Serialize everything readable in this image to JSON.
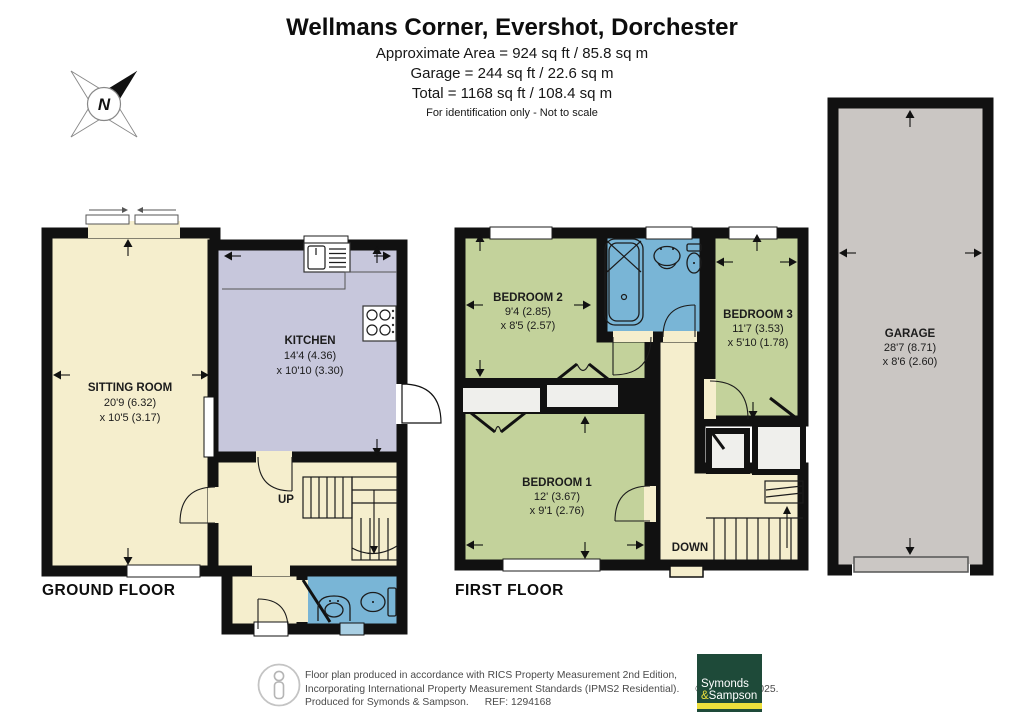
{
  "header": {
    "title": "Wellmans Corner, Evershot, Dorchester",
    "area_line": "Approximate Area = 924 sq ft / 85.8 sq m",
    "garage_line": "Garage = 244 sq ft / 22.6 sq m",
    "total_line": "Total = 1168 sq ft / 108.4 sq m",
    "disclaimer": "For identification only - Not to scale"
  },
  "compass": {
    "north_label": "N"
  },
  "floors": {
    "ground": {
      "label": "GROUND FLOOR",
      "stairs_label": "UP",
      "rooms": {
        "sitting_room": {
          "name": "SITTING ROOM",
          "dim1": "20'9 (6.32)",
          "dim2": "x 10'5 (3.17)"
        },
        "kitchen": {
          "name": "KITCHEN",
          "dim1": "14'4 (4.36)",
          "dim2": "x 10'10 (3.30)"
        }
      }
    },
    "first": {
      "label": "FIRST FLOOR",
      "stairs_label": "DOWN",
      "rooms": {
        "bedroom1": {
          "name": "BEDROOM 1",
          "dim1": "12' (3.67)",
          "dim2": "x 9'1 (2.76)"
        },
        "bedroom2": {
          "name": "BEDROOM 2",
          "dim1": "9'4 (2.85)",
          "dim2": "x 8'5 (2.57)"
        },
        "bedroom3": {
          "name": "BEDROOM 3",
          "dim1": "11'7 (3.53)",
          "dim2": "x 5'10 (1.78)"
        }
      }
    },
    "garage": {
      "rooms": {
        "garage": {
          "name": "GARAGE",
          "dim1": "28'7 (8.71)",
          "dim2": "x 8'6 (2.60)"
        }
      }
    }
  },
  "footer": {
    "line1": "Floor plan produced in accordance with RICS Property Measurement 2nd Edition,",
    "line2": "Incorporating International Property Measurement Standards (IPMS2 Residential).",
    "copyright": "© nichecom 2025.",
    "line3": "Produced for Symonds & Sampson.",
    "ref": "REF: 1294168",
    "logo": {
      "word1": "Symonds",
      "amp": "&",
      "word2": "Sampson"
    }
  },
  "icons": {
    "compass": "compass-rose-north-arrow",
    "footer_person": "person-figure"
  },
  "colors": {
    "room_cream": "#F5EECD",
    "kitchen_lavender": "#C7C7DC",
    "bedroom_green": "#C3D29B",
    "bathroom_blue": "#79B5D6",
    "garage_grey": "#CAC6C3",
    "closet_white": "#EFEFEC",
    "wall_black": "#111111",
    "logo_green": "#1E4A39",
    "logo_yellow": "#EDDF3C"
  }
}
